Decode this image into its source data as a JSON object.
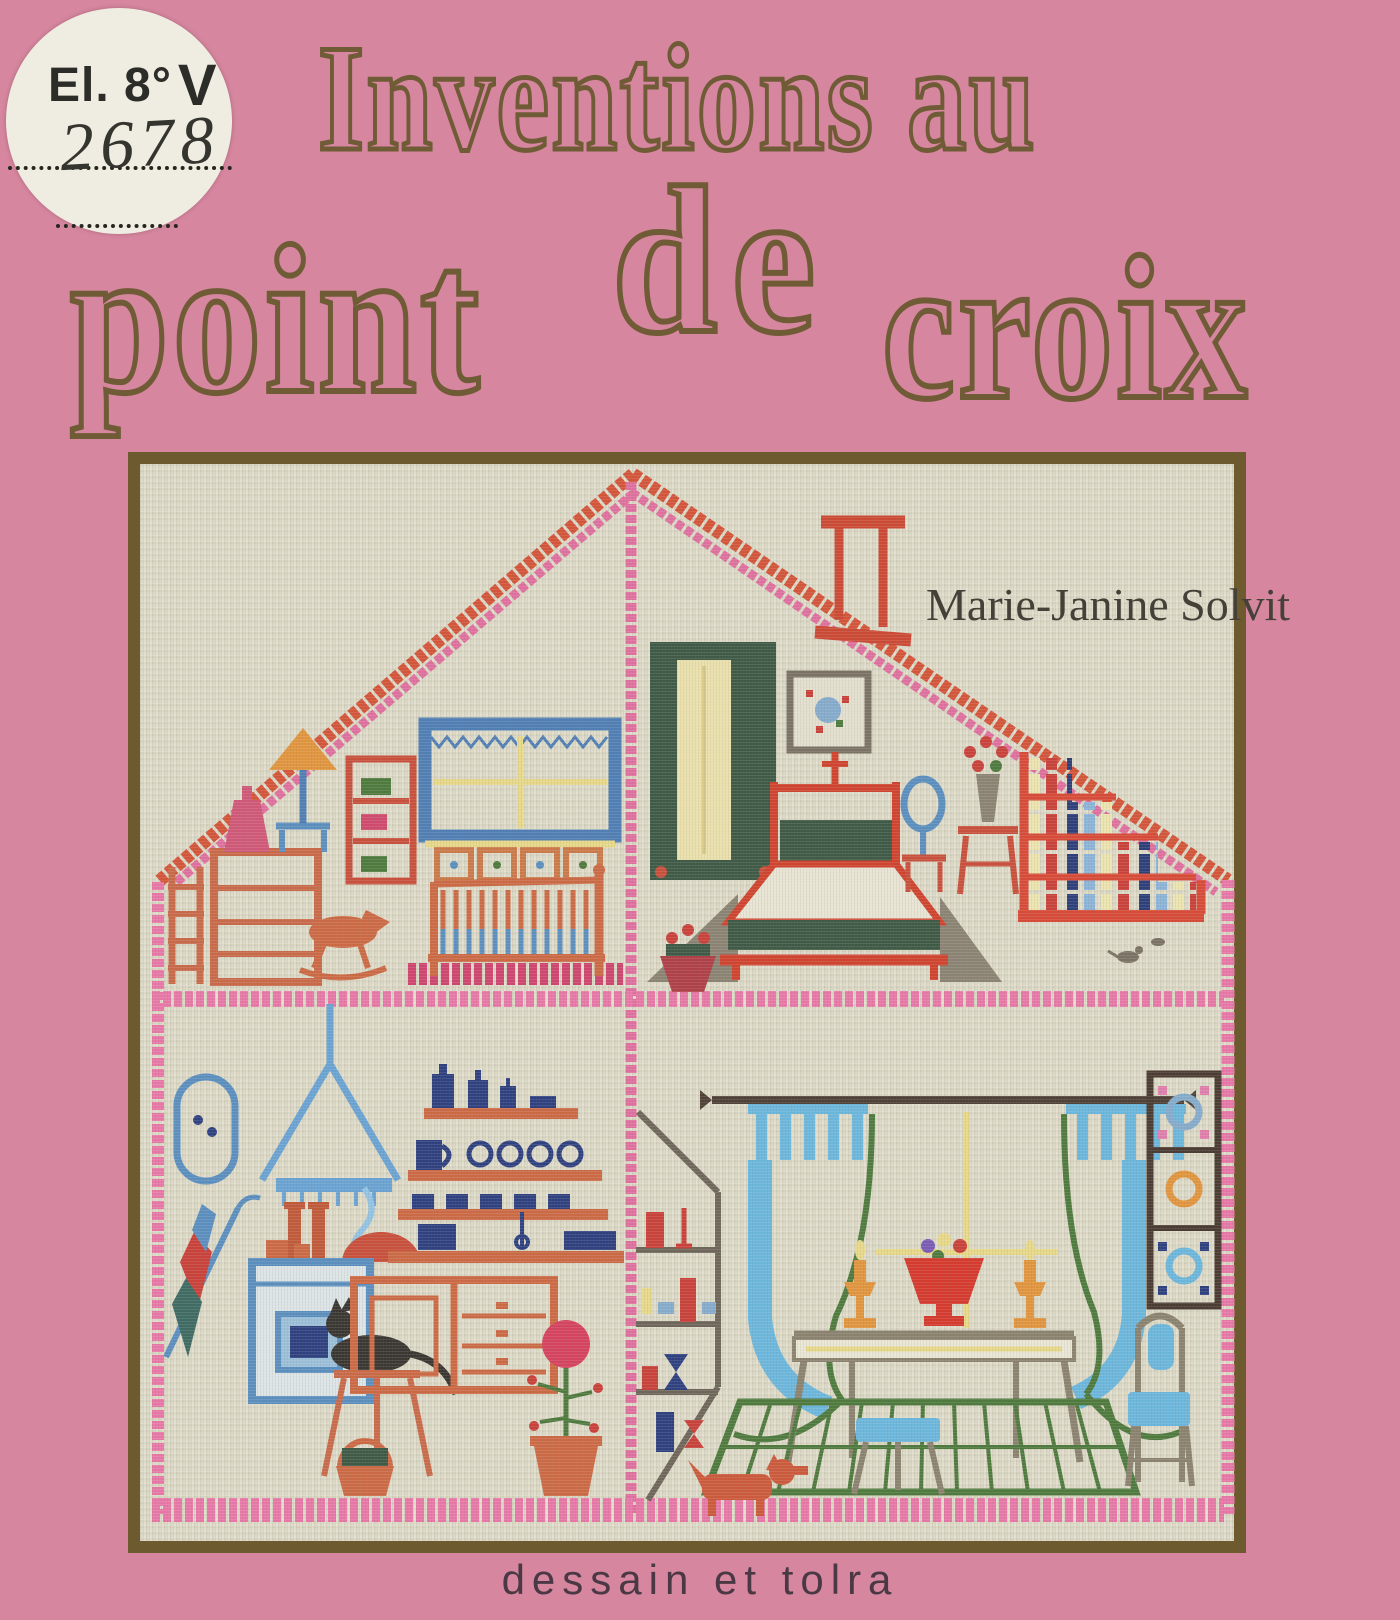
{
  "page": {
    "background": "#d6879f"
  },
  "library_sticker": {
    "classmark": "El. 8°",
    "volume_letter": "V",
    "accession_number": "2678"
  },
  "title": {
    "line1": "Inventions au",
    "word_point": "point",
    "word_de": "de",
    "word_croix": "croix",
    "color": "#6f5b35"
  },
  "author": {
    "name": "Marie-Janine Solvit"
  },
  "publisher": {
    "name": "dessain et tolra"
  },
  "artwork": {
    "type": "cross-stitch embroidery sampler of a dollhouse cross-section",
    "frame_color": "#6d5a2f",
    "fabric_color": "#dcd9c7",
    "rooms": [
      "attic nursery",
      "attic bedroom",
      "kitchen",
      "dining room"
    ],
    "stitch_colors": {
      "roof_red": "#d4553a",
      "border_pink": "#e878a8",
      "rug_crimson": "#cf4570",
      "furniture_orange": "#cc6a45",
      "bright_red": "#c9413a",
      "dark_green": "#3e5a46",
      "leaf_green": "#4e7a3e",
      "window_blue": "#4f7fb5",
      "light_blue": "#6cb7dd",
      "navy": "#2e4080",
      "yellow": "#e8d98a",
      "gray": "#8b8474"
    }
  }
}
